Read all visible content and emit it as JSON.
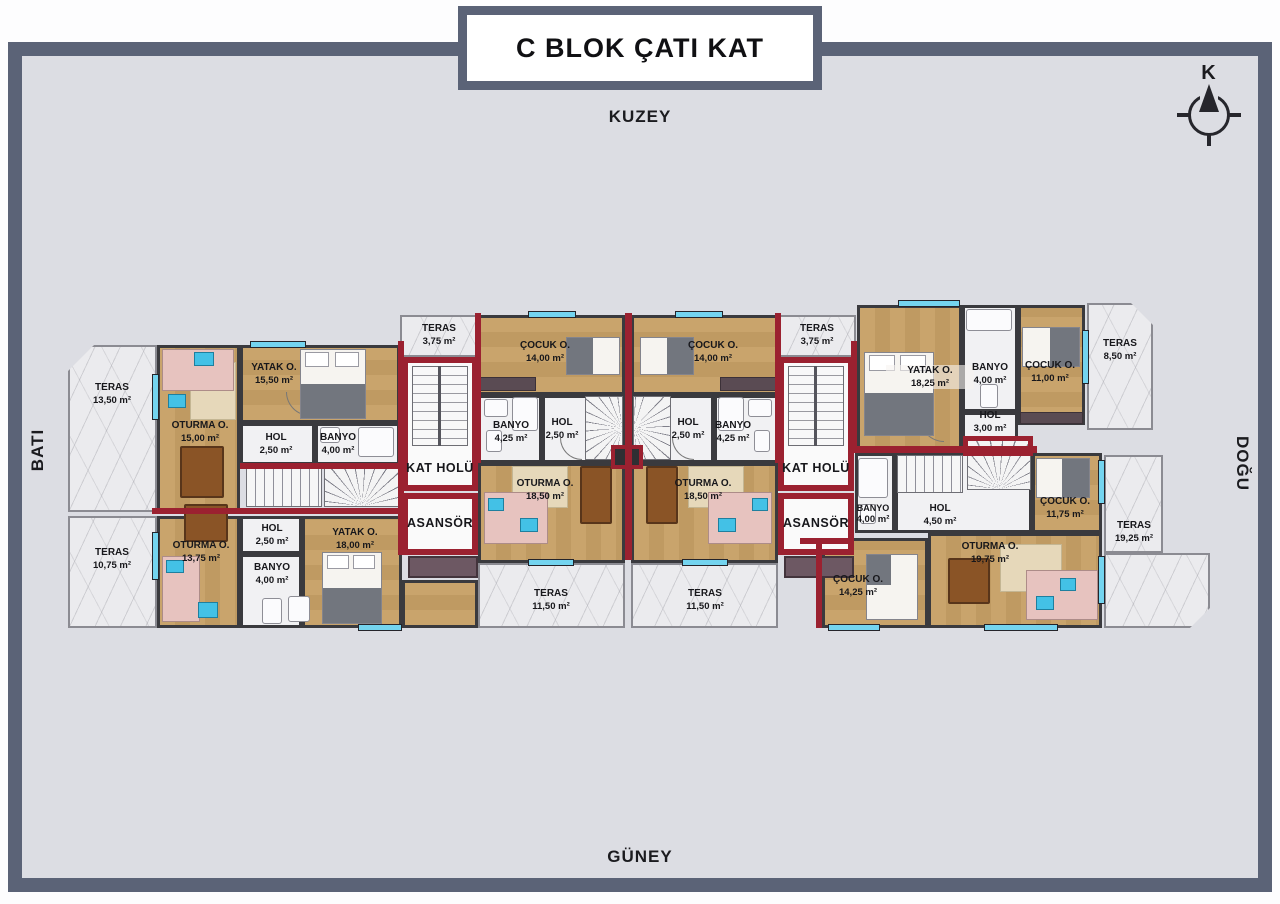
{
  "title": "C BLOK ÇATI KAT",
  "compass": {
    "label": "K"
  },
  "directions": {
    "north": "KUZEY",
    "south": "GÜNEY",
    "west": "BATI",
    "east": "DOĞU"
  },
  "cores": {
    "left": {
      "teras": {
        "label": "TERAS",
        "area": "3,75 m²"
      },
      "kat_holu": {
        "label": "KAT HOLÜ"
      },
      "asansor": {
        "label": "ASANSÖR"
      }
    },
    "right": {
      "teras": {
        "label": "TERAS",
        "area": "3,75 m²"
      },
      "kat_holu": {
        "label": "KAT HOLÜ"
      },
      "asansor": {
        "label": "ASANSÖR"
      }
    }
  },
  "units": {
    "nw": {
      "teras": {
        "label": "TERAS",
        "area": "13,50 m²"
      },
      "oturma": {
        "label": "OTURMA O.",
        "area": "15,00 m²"
      },
      "yatak": {
        "label": "YATAK O.",
        "area": "15,50 m²"
      },
      "hol": {
        "label": "HOL",
        "area": "2,50 m²"
      },
      "banyo": {
        "label": "BANYO",
        "area": "4,00 m²"
      }
    },
    "sw": {
      "teras": {
        "label": "TERAS",
        "area": "10,75 m²"
      },
      "oturma": {
        "label": "OTURMA O.",
        "area": "13,75 m²"
      },
      "hol": {
        "label": "HOL",
        "area": "2,50 m²"
      },
      "banyo": {
        "label": "BANYO",
        "area": "4,00 m²"
      },
      "yatak": {
        "label": "YATAK O.",
        "area": "18,00 m²"
      }
    },
    "cl": {
      "cocuk": {
        "label": "ÇOCUK O.",
        "area": "14,00 m²"
      },
      "banyo": {
        "label": "BANYO",
        "area": "4,25 m²"
      },
      "hol": {
        "label": "HOL",
        "area": "2,50 m²"
      },
      "oturma": {
        "label": "OTURMA O.",
        "area": "18,50 m²"
      },
      "teras": {
        "label": "TERAS",
        "area": "11,50 m²"
      }
    },
    "cr": {
      "cocuk": {
        "label": "ÇOCUK O.",
        "area": "14,00 m²"
      },
      "hol": {
        "label": "HOL",
        "area": "2,50 m²"
      },
      "banyo": {
        "label": "BANYO",
        "area": "4,25 m²"
      },
      "oturma": {
        "label": "OTURMA O.",
        "area": "18,50 m²"
      },
      "teras": {
        "label": "TERAS",
        "area": "11,50 m²"
      }
    },
    "ne": {
      "yatak": {
        "label": "YATAK O.",
        "area": "18,25 m²"
      },
      "banyo": {
        "label": "BANYO",
        "area": "4,00 m²"
      },
      "cocuk": {
        "label": "ÇOCUK O.",
        "area": "11,00 m²"
      },
      "hol": {
        "label": "HOL",
        "area": "3,00 m²"
      },
      "teras": {
        "label": "TERAS",
        "area": "8,50 m²"
      }
    },
    "se": {
      "banyo": {
        "label": "BANYO",
        "area": "4,00 m²"
      },
      "hol": {
        "label": "HOL",
        "area": "4,50 m²"
      },
      "cocuk1": {
        "label": "ÇOCUK O.",
        "area": "11,75 m²"
      },
      "oturma": {
        "label": "OTURMA O.",
        "area": "19,75 m²"
      },
      "cocuk2": {
        "label": "ÇOCUK O.",
        "area": "14,25 m²"
      },
      "teras": {
        "label": "TERAS",
        "area": "19,25 m²"
      }
    }
  }
}
